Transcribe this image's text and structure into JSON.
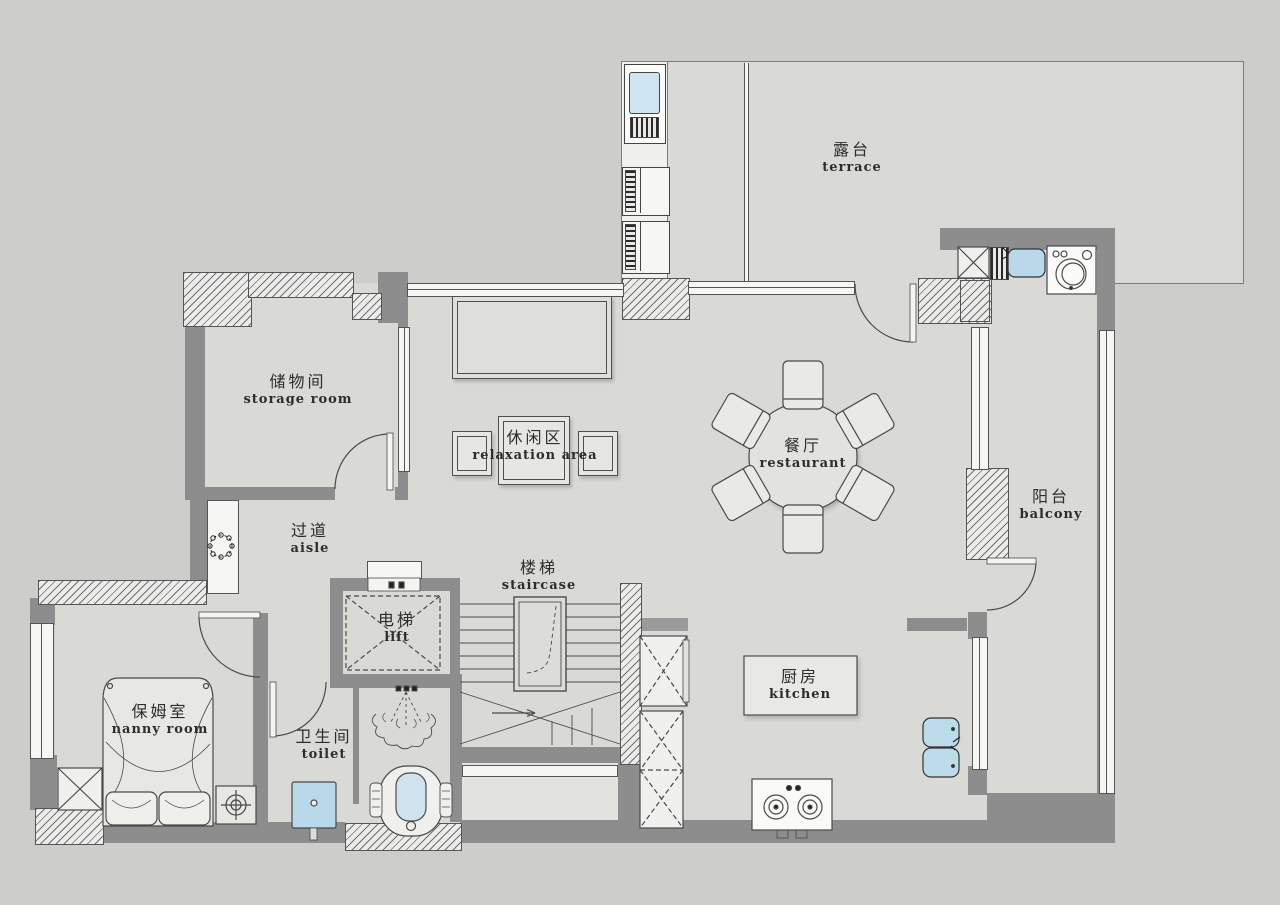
{
  "plan_title": "floor plan",
  "rooms": {
    "terrace": {
      "zh": "露台",
      "en": "terrace"
    },
    "storage_room": {
      "zh": "储物间",
      "en": "storage room"
    },
    "relaxation_area": {
      "zh": "休闲区",
      "en": "relaxation area"
    },
    "restaurant": {
      "zh": "餐厅",
      "en": "restaurant"
    },
    "balcony": {
      "zh": "阳台",
      "en": "balcony"
    },
    "aisle": {
      "zh": "过道",
      "en": "aisle"
    },
    "staircase": {
      "zh": "楼梯",
      "en": "staircase"
    },
    "lift": {
      "zh": "电梯",
      "en": "lift"
    },
    "nanny_room": {
      "zh": "保姆室",
      "en": "nanny room"
    },
    "toilet": {
      "zh": "卫生间",
      "en": "toilet"
    },
    "kitchen": {
      "zh": "厨房",
      "en": "kitchen"
    }
  },
  "fixtures": {
    "dining_table_seats": 6,
    "items": [
      "water-heater",
      "ac-outdoor-unit",
      "ac-outdoor-unit",
      "drying-rack",
      "laundry-sink",
      "washing-machine",
      "wall-cabinet",
      "coffee-table",
      "side-table",
      "side-table",
      "round-dining-table",
      "wreath-plant",
      "bed",
      "pillow",
      "pillow",
      "nightstand-lamp",
      "storage-box",
      "wash-basin",
      "shower-head",
      "toilet-bowl",
      "kitchen-island",
      "gas-stove",
      "double-sink",
      "tall-cabinet",
      "tall-cabinet",
      "lift-shaft",
      "stairs"
    ]
  },
  "colors": {
    "background": "#cdcdcb",
    "floor": "#d9d9d6",
    "wall": "#8d8d8d",
    "line": "#4a4a4a",
    "furniture": "#e6e6e3",
    "fixture_blue": "#b9d8e9",
    "white": "#f4f4f2"
  }
}
